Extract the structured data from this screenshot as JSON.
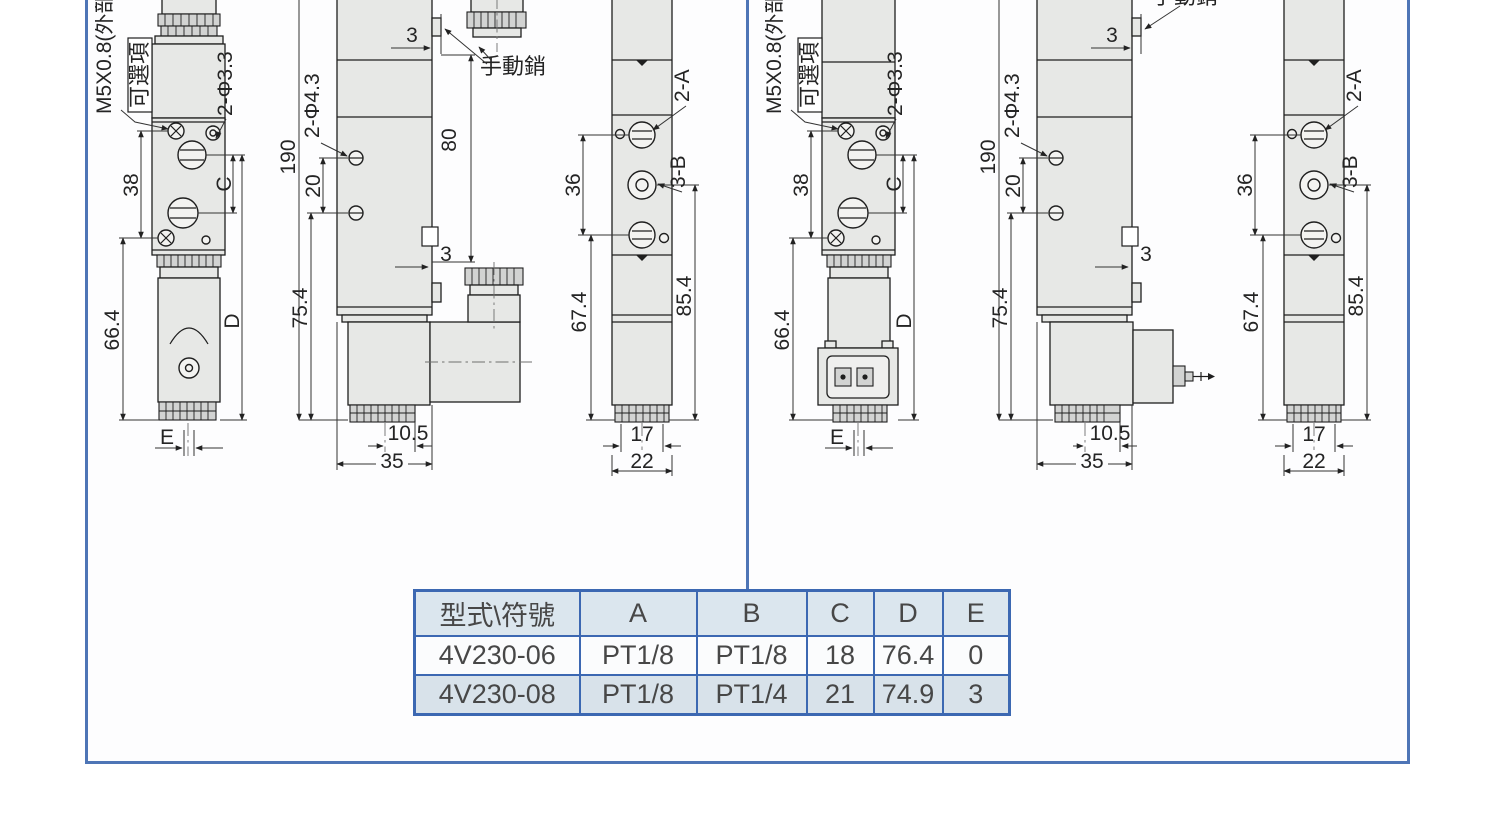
{
  "labels": {
    "thread_spec": "M5X0.8(外部)",
    "optional": "可選項",
    "holes_phi33": "2-Φ3.3",
    "holes_phi43": "2-Φ4.3",
    "manual_pin": "手動銷",
    "port_2a": "2-A",
    "port_3b": "3-B",
    "dim_38": "38",
    "dim_66_4": "66.4",
    "dim_c": "C",
    "dim_d": "D",
    "dim_e": "E",
    "dim_190": "190",
    "dim_20": "20",
    "dim_3": "3",
    "dim_80": "80",
    "dim_75_4": "75.4",
    "dim_10_5": "10.5",
    "dim_35": "35",
    "dim_36": "36",
    "dim_67_4": "67.4",
    "dim_85_4": "85.4",
    "dim_17": "17",
    "dim_22": "22"
  },
  "table": {
    "headers": [
      "型式\\符號",
      "A",
      "B",
      "C",
      "D",
      "E"
    ],
    "rows": [
      {
        "model": "4V230-06",
        "a": "PT1/8",
        "b": "PT1/8",
        "c": "18",
        "d": "76.4",
        "e": "0"
      },
      {
        "model": "4V230-08",
        "a": "PT1/8",
        "b": "PT1/4",
        "c": "21",
        "d": "74.9",
        "e": "3"
      }
    ]
  },
  "colors": {
    "frame_blue": "#4e75b6",
    "table_border": "#3c68b2",
    "table_header_bg": "#dbe6ee",
    "table_alt_row_bg": "#d8e2ea",
    "part_fill": "#e7e8e6",
    "line": "#1f1f1f"
  }
}
